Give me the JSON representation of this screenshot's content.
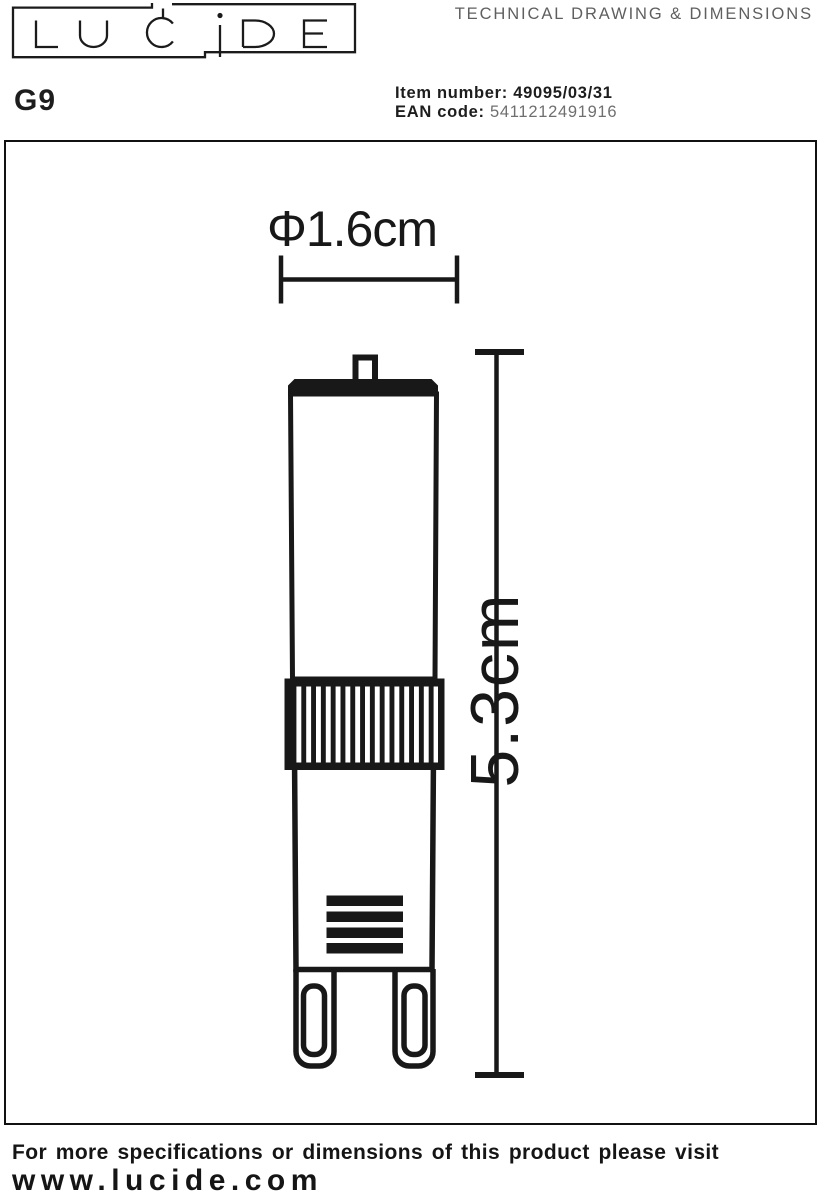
{
  "header": {
    "logo_text": "LUCIDE",
    "sheet_title": "TECHNICAL DRAWING & DIMENSIONS"
  },
  "product": {
    "model": "G9",
    "item_number_label": "Item number:",
    "item_number_value": "49095/03/31",
    "ean_label": "EAN code:",
    "ean_value": "5411212491916"
  },
  "drawing": {
    "width_dimension_label": "Φ1.6cm",
    "height_dimension_label": "5.3cm"
  },
  "footer": {
    "note": "For more specifications or dimensions of this product please visit",
    "website": "www.lucide.com"
  },
  "colors": {
    "ink": "#181818",
    "muted_text": "#5f5f5f",
    "ean_value_color": "#6f6f6f"
  }
}
